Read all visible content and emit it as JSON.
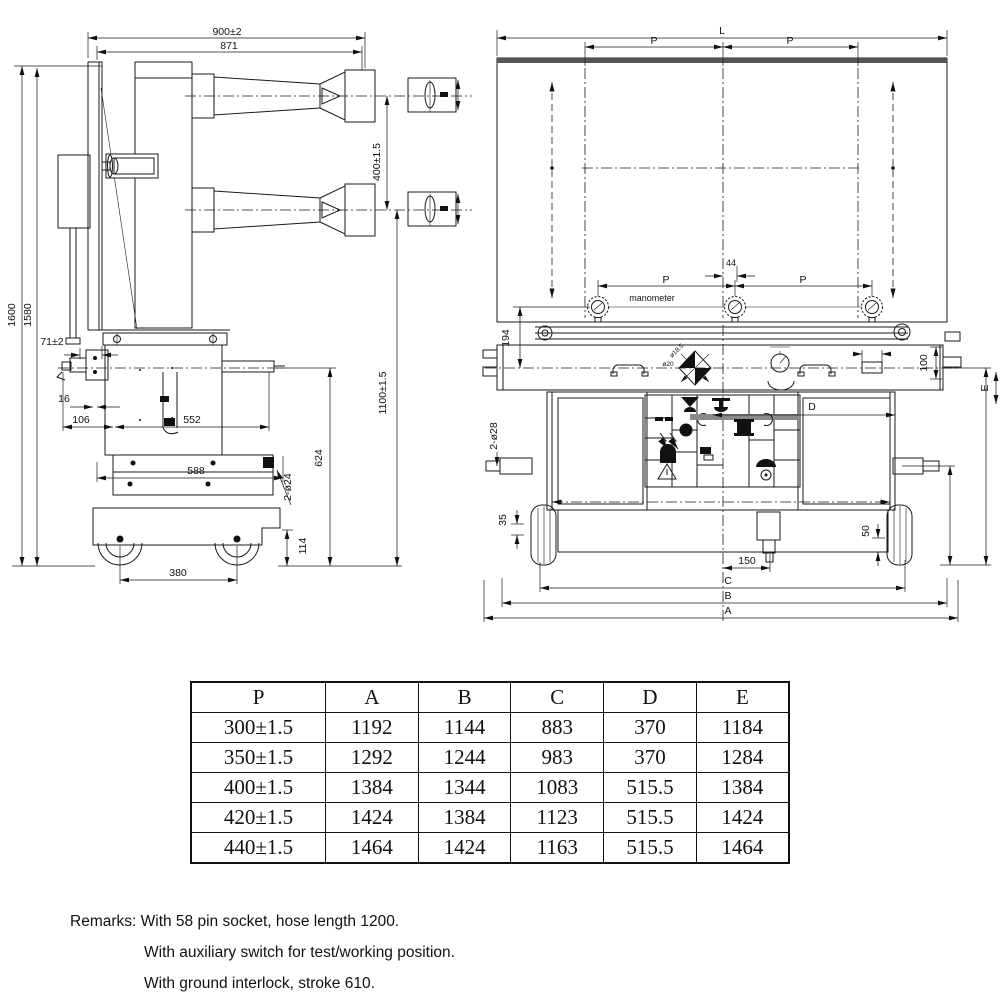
{
  "drawing": {
    "side_view": {
      "d900": "900±2",
      "d871": "871",
      "d1600": "1600",
      "d1580": "1580",
      "d71": "71±2",
      "d400": "400±1.5",
      "d1100": "1100±1.5",
      "d16": "16",
      "d106": "106",
      "d552": "552",
      "d588": "588",
      "d624": "624",
      "d2o24": "2-ø24",
      "d114": "114",
      "d380": "380"
    },
    "top_view": {
      "dL": "L",
      "dP1": "P",
      "dP2": "P",
      "d44": "44",
      "dP3": "P",
      "dP4": "P",
      "d194": "194",
      "manometer": "manometer"
    },
    "front_view": {
      "d100": "100",
      "d2o28": "2-ø28",
      "d35": "35",
      "d50": "50",
      "d150": "150",
      "dC": "C",
      "dB": "B",
      "dA": "A",
      "dD": "D",
      "dE": "E",
      "d596": "596±1.5",
      "d314": "314",
      "do20": "ø20",
      "do185": "ø18.5"
    }
  },
  "table": {
    "headers": [
      "P",
      "A",
      "B",
      "C",
      "D",
      "E"
    ],
    "rows": [
      [
        "300±1.5",
        "1192",
        "1144",
        "883",
        "370",
        "1184"
      ],
      [
        "350±1.5",
        "1292",
        "1244",
        "983",
        "370",
        "1284"
      ],
      [
        "400±1.5",
        "1384",
        "1344",
        "1083",
        "515.5",
        "1384"
      ],
      [
        "420±1.5",
        "1424",
        "1384",
        "1123",
        "515.5",
        "1424"
      ],
      [
        "440±1.5",
        "1464",
        "1424",
        "1163",
        "515.5",
        "1464"
      ]
    ]
  },
  "remarks": {
    "line1": "Remarks: With 58 pin socket, hose length 1200.",
    "line2": "With auxiliary switch for test/working position.",
    "line3": "With ground interlock, stroke 610."
  }
}
